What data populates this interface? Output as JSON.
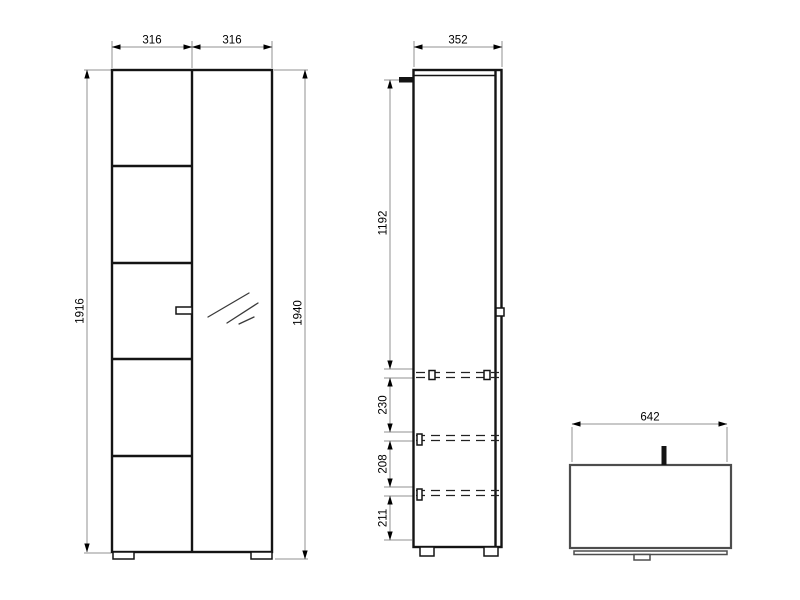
{
  "drawing": {
    "type": "furniture-technical-drawing",
    "views": {
      "front": {
        "name": "wardrobe-front-view",
        "dims": {
          "door_left_width": "316",
          "door_right_width": "316",
          "body_height": "1916",
          "total_height": "1940"
        }
      },
      "side": {
        "name": "wardrobe-side-view",
        "dims": {
          "depth": "352",
          "top_section_height": "1192",
          "shelf_spacing_1": "230",
          "shelf_spacing_2": "208",
          "shelf_spacing_3": "211"
        }
      },
      "bench": {
        "name": "bench-front-view",
        "dims": {
          "width": "642"
        }
      }
    },
    "colors": {
      "object_line": "#141414",
      "bench_line": "#4d4d4d",
      "dimension_line": "#909090",
      "text": "#000000",
      "background": "#ffffff"
    }
  }
}
